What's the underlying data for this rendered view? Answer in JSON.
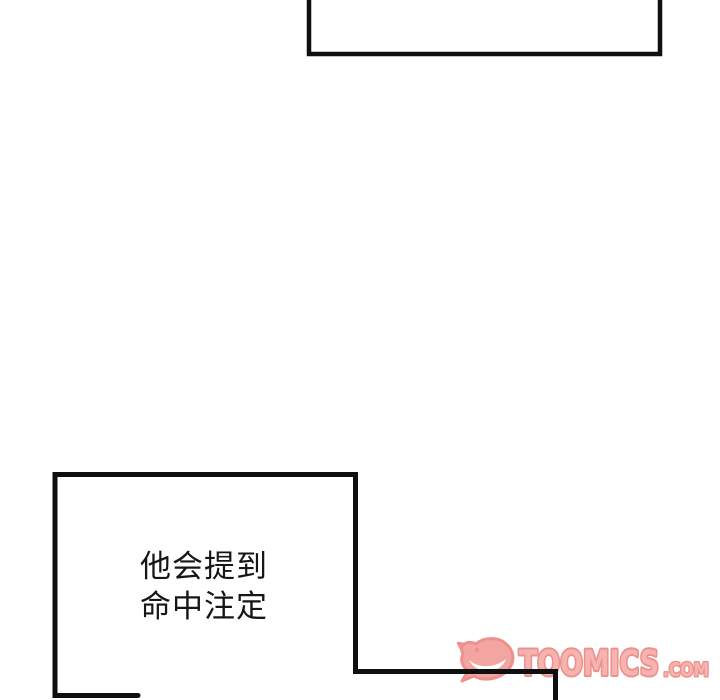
{
  "comic": {
    "top_bubble": {
      "text": ""
    },
    "dialogue_bubble": {
      "line1": "他会提到",
      "line2": "命中注定"
    }
  },
  "watermark": {
    "brand": "TOOMICS",
    "suffix": ".COM",
    "icon": "devil-face-icon",
    "fill_color": "#f7b3af",
    "outline_color": "#ec918d"
  },
  "colors": {
    "background": "#ffffff",
    "panel_line": "#0f0f0f",
    "text": "#161616"
  }
}
